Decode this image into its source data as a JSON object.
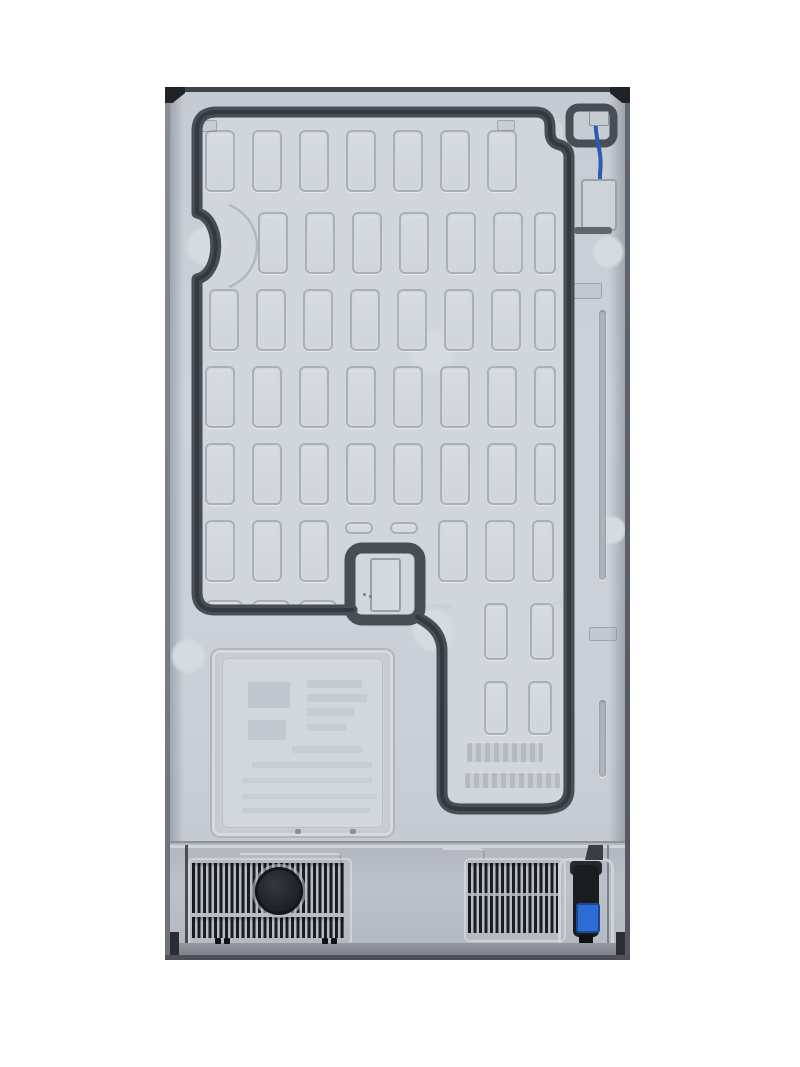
{
  "image": {
    "title": "Rear view of a refrigerator — embossed metal back panel with compressor vents, power cord and water line",
    "background": "#ffffff"
  },
  "fridge": {
    "x": 165,
    "y": 87,
    "width": 465,
    "height": 873,
    "colors": {
      "panel": "#c9cdd5",
      "panel_inner": "#d1d5dc",
      "channel_groove": "#484d56",
      "edge_dark": "#3f434a",
      "corner_cap": "#1f2227",
      "compartment": "#b7bbc4",
      "vent_slat": "#1b1d21",
      "vent_knockout_cap": "#1e2126",
      "water_tube_blue": "#2a5cb0",
      "plug_connector_blue": "#2e6bd4",
      "plug_body": "#1a1c20",
      "bottom_strip": "#9297a1"
    },
    "ribs": {
      "rows": [
        {
          "y": 43,
          "h": 62,
          "w": 30,
          "xs": [
            40,
            87,
            134,
            181,
            228,
            275,
            322
          ]
        },
        {
          "y": 125,
          "h": 62,
          "w": 30,
          "xs": [
            93,
            140,
            187,
            234,
            281,
            328
          ],
          "narrow_x": 369,
          "narrow_w": 22
        },
        {
          "y": 202,
          "h": 62,
          "w": 30,
          "xs": [
            44,
            91,
            138,
            185,
            232,
            279,
            326
          ],
          "narrow_x": 369,
          "narrow_w": 22
        },
        {
          "y": 279,
          "h": 62,
          "w": 30,
          "xs": [
            40,
            87,
            134,
            181,
            228,
            275,
            322
          ],
          "narrow_x": 369,
          "narrow_w": 22
        },
        {
          "y": 356,
          "h": 62,
          "w": 30,
          "xs": [
            40,
            87,
            134,
            181,
            228,
            275,
            322
          ],
          "narrow_x": 369,
          "narrow_w": 22
        },
        {
          "y": 433,
          "h": 62,
          "w": 30,
          "xs": [
            40,
            87,
            134,
            273,
            320
          ],
          "narrow_x": 367,
          "narrow_w": 22
        },
        {
          "y": 516,
          "h": 57,
          "w": 24,
          "xs": [
            319,
            365
          ]
        },
        {
          "y": 594,
          "h": 54,
          "w": 24,
          "xs": [
            319,
            363
          ]
        }
      ]
    },
    "ovals": [
      {
        "x": 40,
        "y": 513,
        "w": 38,
        "h": 13
      },
      {
        "x": 87,
        "y": 513,
        "w": 38,
        "h": 13
      },
      {
        "x": 134,
        "y": 513,
        "w": 38,
        "h": 13
      },
      {
        "x": 180,
        "y": 435,
        "w": 28,
        "h": 12
      },
      {
        "x": 225,
        "y": 435,
        "w": 28,
        "h": 12
      }
    ],
    "knockouts": [
      {
        "cx": 41,
        "cy": 159,
        "r": 21
      },
      {
        "cx": 267,
        "cy": 265,
        "r": 23
      },
      {
        "cx": 268,
        "cy": 543,
        "r": 23
      },
      {
        "cx": 23,
        "cy": 569,
        "r": 18
      },
      {
        "cx": 443,
        "cy": 165,
        "r": 17
      },
      {
        "cx": 447,
        "cy": 443,
        "r": 15
      }
    ],
    "grooves": [
      {
        "x": 434,
        "y": 223,
        "h": 270
      },
      {
        "x": 434,
        "y": 613,
        "h": 77
      }
    ],
    "marks": [
      {
        "x": 36,
        "y": 33,
        "w": 14,
        "h": 10
      },
      {
        "x": 332,
        "y": 33,
        "w": 16,
        "h": 9
      },
      {
        "x": 405,
        "y": 196,
        "w": 30,
        "h": 14
      },
      {
        "x": 424,
        "y": 540,
        "w": 26,
        "h": 12
      }
    ],
    "emboss_text_rows": [
      {
        "x": 302,
        "y": 655,
        "w": 76,
        "h": 20
      },
      {
        "x": 300,
        "y": 685,
        "w": 95,
        "h": 16
      }
    ],
    "label_panel": {
      "x": 45,
      "y": 561,
      "w": 185,
      "h": 190,
      "bars": [
        {
          "x": 26,
          "y": 24,
          "w": 42,
          "h": 26,
          "o": 0.55
        },
        {
          "x": 26,
          "y": 62,
          "w": 38,
          "h": 20,
          "o": 0.45
        },
        {
          "x": 85,
          "y": 22,
          "w": 55,
          "h": 8,
          "o": 0.4
        },
        {
          "x": 85,
          "y": 36,
          "w": 60,
          "h": 8,
          "o": 0.4
        },
        {
          "x": 85,
          "y": 50,
          "w": 48,
          "h": 8,
          "o": 0.35
        },
        {
          "x": 85,
          "y": 66,
          "w": 40,
          "h": 7,
          "o": 0.35
        },
        {
          "x": 70,
          "y": 88,
          "w": 70,
          "h": 7,
          "o": 0.3
        },
        {
          "x": 30,
          "y": 104,
          "w": 120,
          "h": 6,
          "o": 0.3
        },
        {
          "x": 20,
          "y": 120,
          "w": 130,
          "h": 5,
          "o": 0.3
        },
        {
          "x": 20,
          "y": 136,
          "w": 135,
          "h": 5,
          "o": 0.3
        },
        {
          "x": 20,
          "y": 150,
          "w": 128,
          "h": 5,
          "o": 0.3
        }
      ]
    },
    "vents": {
      "left": {
        "x": 27,
        "y": 776,
        "w": 152,
        "band1_h": 50,
        "gap": 4,
        "band2_h": 21
      },
      "right": {
        "x": 303,
        "y": 776,
        "w": 90,
        "h": 70,
        "seam_y": 806
      }
    },
    "dashes": [
      {
        "x": 50,
        "y": 851,
        "w": 6,
        "h": 6
      },
      {
        "x": 59,
        "y": 851,
        "w": 6,
        "h": 6
      },
      {
        "x": 157,
        "y": 851,
        "w": 6,
        "h": 6
      },
      {
        "x": 166,
        "y": 851,
        "w": 6,
        "h": 6
      }
    ]
  }
}
